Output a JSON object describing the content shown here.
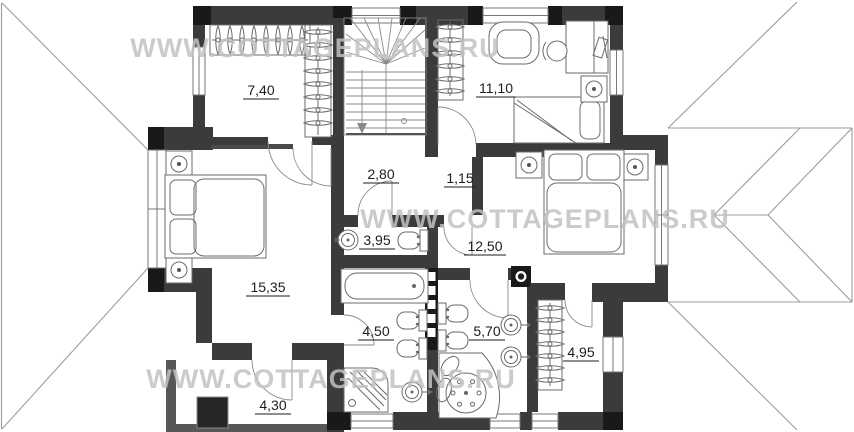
{
  "watermark": {
    "text": "WWW.COTTAGEPLANS.RU"
  },
  "plan": {
    "type": "floor-plan",
    "rooms": {
      "dressing": {
        "area": "7,40"
      },
      "bedroom_top": {
        "area": "11,10"
      },
      "hall": {
        "area": "2,80"
      },
      "lobby": {
        "area": "1,15"
      },
      "wc": {
        "area": "3,95"
      },
      "bedroom_right": {
        "area": "12,50"
      },
      "bedroom_master": {
        "area": "15,35"
      },
      "bath_a": {
        "area": "4,50"
      },
      "bath_b": {
        "area": "5,70"
      },
      "closet": {
        "area": "4,95"
      },
      "balcony": {
        "area": "4,30"
      }
    },
    "colors": {
      "wall": "#3b3b3b",
      "wall_dark": "#191919",
      "balcony_wall": "#575757",
      "window_frame": "#777777",
      "furniture_line": "#6b6b6b",
      "roof_line": "#9c9c9c",
      "label_text": "#1d1d1d",
      "watermark": "#c2c2c2",
      "background": "#ffffff"
    }
  }
}
